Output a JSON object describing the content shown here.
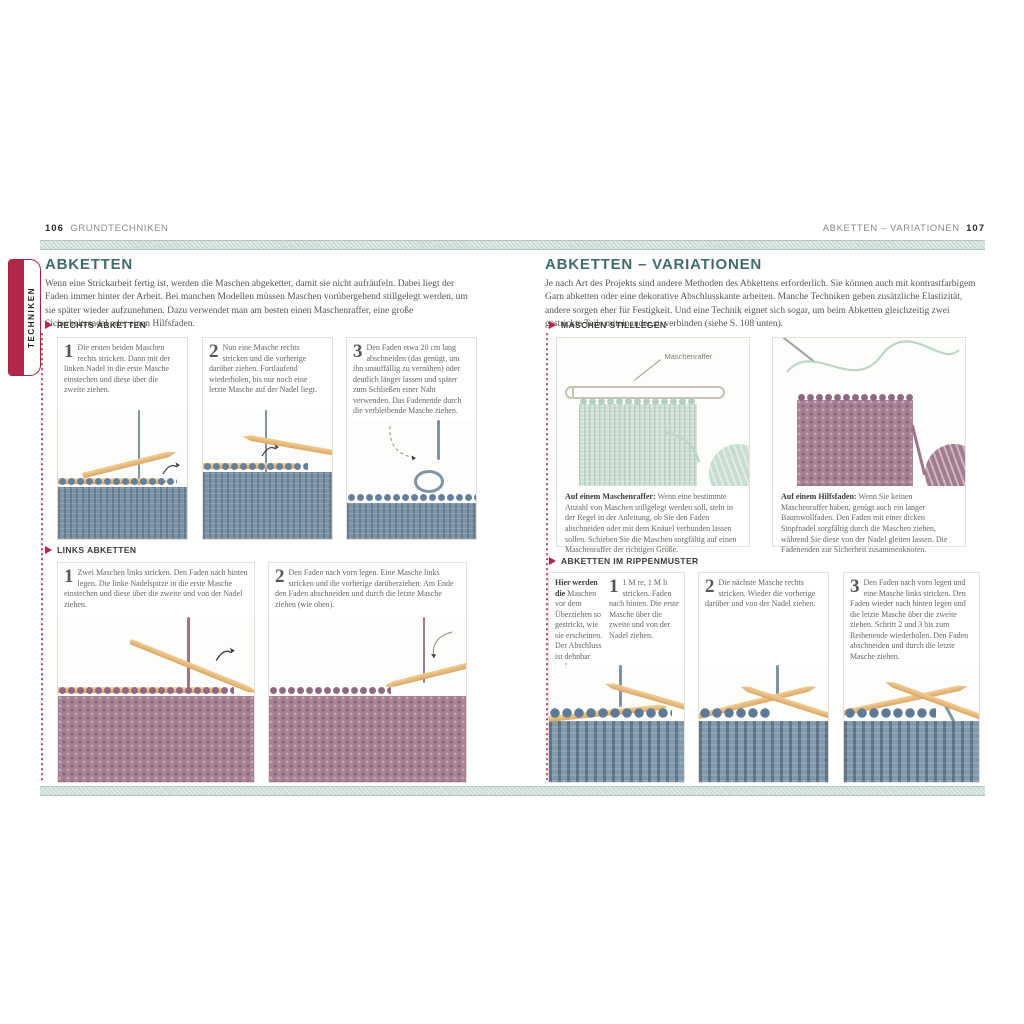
{
  "header": {
    "left_page_number": "106",
    "left_running_head": "GRUNDTECHNIKEN",
    "right_running_head": "ABKETTEN – VARIATIONEN",
    "right_page_number": "107"
  },
  "tab_label": "TECHNIKEN",
  "left": {
    "title": "ABKETTEN",
    "intro": "Wenn eine Strickarbeit fertig ist, werden die Maschen abgekettet, damit sie nicht aufräufeln. Dabei liegt der Faden immer hinter der Arbeit. Bei manchen Modellen müssen Maschen vorübergehend stillgelegt werden, um sie später wieder aufzunehmen. Dazu verwendet man am besten einen Maschenraffer, eine große Sicherheitsnadel oder einen Hilfsfaden.",
    "sections": [
      {
        "title": "RECHTS ABKETTEN",
        "steps": [
          {
            "num": "1",
            "text": "Die ersten beiden Maschen rechts stricken. Dann mit der linken Nadel in die erste Masche einstechen und diese über die zweite ziehen."
          },
          {
            "num": "2",
            "text": "Nun eine Masche rechts stricken und die vorherige darüber ziehen. Fortlaufend wiederholen, bis nur noch eine letzte Masche auf der Nadel liegt."
          },
          {
            "num": "3",
            "text": "Den Faden etwa 20 cm lang abschneiden (das genügt, um ihn unauffällig zu vernähen) oder deutlich länger lassen und später zum Schließen einer Naht verwenden. Das Fadenende durch die verbleibende Masche ziehen."
          }
        ]
      },
      {
        "title": "LINKS ABKETTEN",
        "steps": [
          {
            "num": "1",
            "text": "Zwei Maschen links stricken. Den Faden nach hinten legen. Die linke Nadelspitze in die erste Masche einstechen und diese über die zweite und von der Nadel ziehen."
          },
          {
            "num": "2",
            "text": "Den Faden nach vorn legen. Eine Masche links stricken und die vorherige darüberziehen. Am Ende den Faden abschneiden und durch die letzte Masche ziehen (wie oben)."
          }
        ]
      }
    ]
  },
  "right": {
    "title": "ABKETTEN – VARIATIONEN",
    "intro": "Je nach Art des Projekts sind andere Methoden des Abkettens erforderlich. Sie können auch mit kontrastfarbigem Garn abketten oder eine dekorative Abschlusskante arbeiten. Manche Techniken geben zusätzliche Elastizität, andere sorgen eher für Festigkeit. Und eine Technik eignet sich sogar, um beim Abketten gleichzeitig zwei gestrickte Teile miteinander zu verbinden (siehe S. 108 unten).",
    "stilllegen": {
      "title": "MASCHEN STILLLEGEN",
      "photo_label": "Maschenraffer",
      "captions": [
        {
          "lead": "Auf einem Maschenraffer:",
          "text": " Wenn eine bestimmte Anzahl von Maschen stillgelegt werden soll, steht in der Regel in der Anleitung, ob Sie den Faden abschneiden oder mit dem Knäuel verbunden lassen sollen. Schieben Sie die Maschen sorgfältig auf einen Maschenraffer der richtigen Größe."
        },
        {
          "lead": "Auf einem Hilfsfaden:",
          "text": " Wenn Sie keinen Maschenraffer haben, genügt auch ein langer Baumwollfaden. Den Faden mit einer dicken Stopfnadel sorgfältig durch die Maschen ziehen, während Sie diese von der Nadel gleiten lassen. Die Fadenenden zur Sicherheit zusammenknoten."
        }
      ]
    },
    "rippen": {
      "title": "ABKETTEN IM RIPPENMUSTER",
      "note_lead": "Hier werden die",
      "note_text": " Maschen vor dem Überziehen so gestrickt, wie sie erscheinen. Der Abschluss ist dehnbar und unauffällig.",
      "steps": [
        {
          "num": "1",
          "text": "1 M re, 1 M li stricken. Faden nach hinten. Die erste Masche über die zweite und von der Nadel ziehen."
        },
        {
          "num": "2",
          "text": "Die nächste Masche rechts stricken. Wieder die vorherige darüber und von der Nadel ziehen."
        },
        {
          "num": "3",
          "text": "Den Faden nach vorn legen und eine Masche links stricken. Den Faden wieder nach hinten legen und die letzte Masche über die zweite ziehen. Schritt 2 und 3 bis zum Reihenende wiederholen. Den Faden abschneiden und durch die letzte Masche ziehen."
        }
      ]
    }
  },
  "colors": {
    "accent_red": "#b02747",
    "heading_teal": "#3e6c6a",
    "band_teal": "#c9dbd3",
    "knit_blue": "#7e94a5",
    "knit_mauve": "#a68093",
    "knit_mint": "#cfe1d7",
    "needle_wood": "#e9bd82"
  }
}
